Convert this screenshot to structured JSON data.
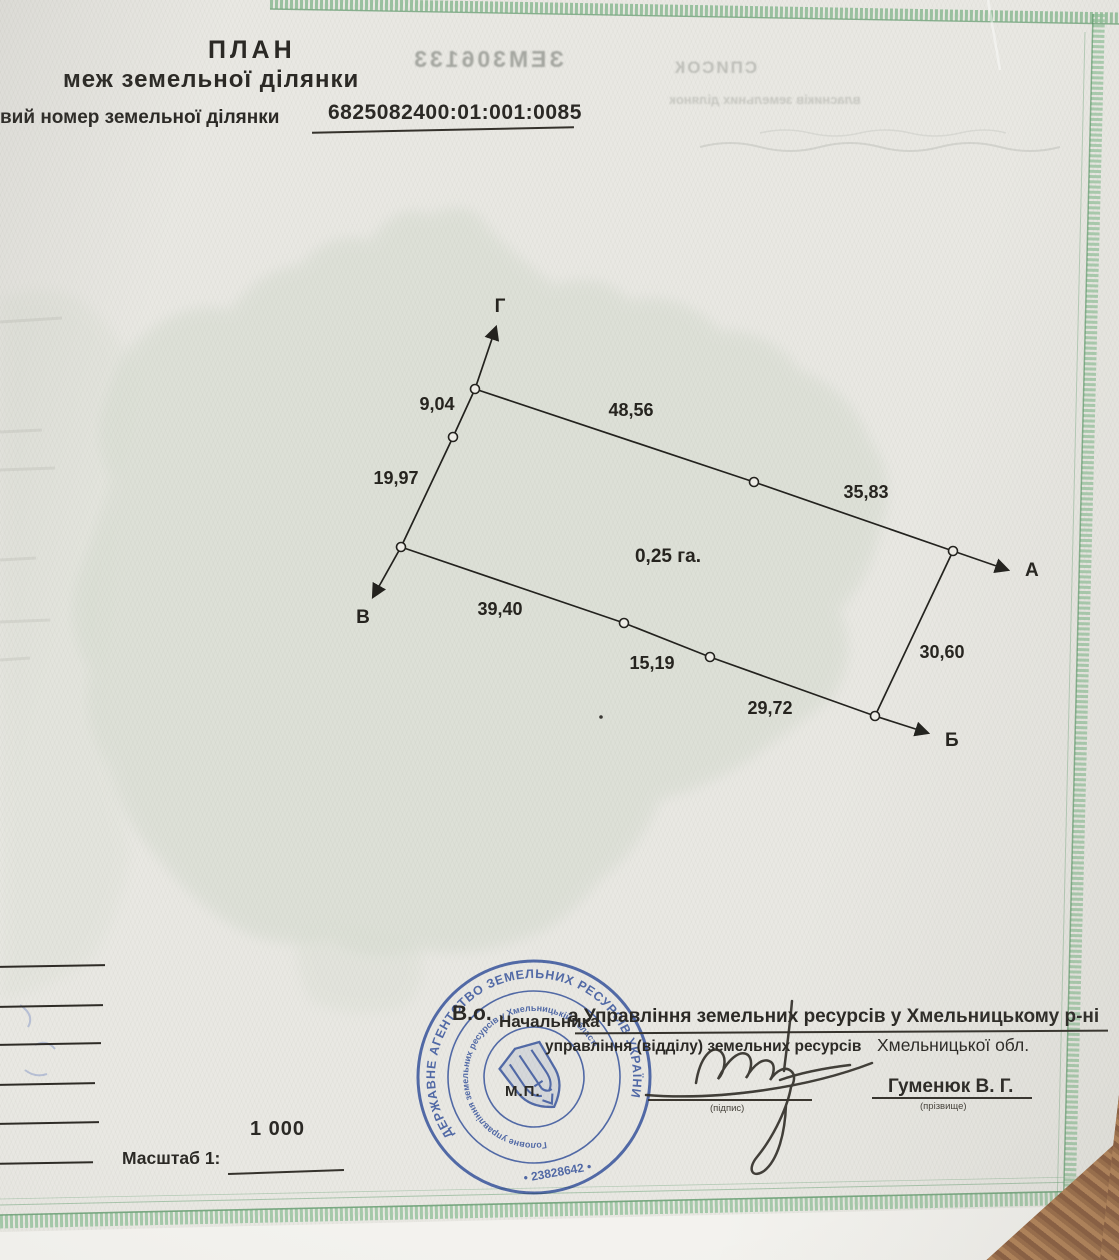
{
  "header": {
    "title": "ПЛАН",
    "subtitle": "меж земельної ділянки",
    "cadastral_label": "вий номер земельної ділянки",
    "cadastral_number": "6825082400:01:001:0085"
  },
  "plan": {
    "area": "0,25 га.",
    "points": {
      "top": "Г",
      "right": "А",
      "bottom": "Б",
      "left": "В"
    },
    "lengths": {
      "g_upper": "9,04",
      "g_lower": "19,97",
      "top_left": "48,56",
      "top_right": "35,83",
      "bottom_left": "39,40",
      "bottom_mid": "15,19",
      "bottom_right": "29,72",
      "right_side": "30,60"
    }
  },
  "scale": {
    "label": "Масштаб 1:",
    "value": "1 000"
  },
  "signing": {
    "acting": "В.о.",
    "position_printed": "Начальника",
    "typed_line": "а Управління земельних ресурсів у Хмельницькому р-ні",
    "form_line": "управління (відділу) земельних ресурсів",
    "region": "Хмельницької обл.",
    "seal_mark": "М.П.",
    "signature_caption": "(підпис)",
    "surname": "Гуменюк В. Г.",
    "surname_caption": "(прізвище)"
  },
  "stamp": {
    "ring_outer": "ДЕРЖАВНЕ АГЕНТСТВО ЗЕМЕЛЬНИХ РЕСУРСІВ УКРАЇНИ",
    "ring_number": "• 23828642 •",
    "ring_inner": "Головне управління земельних ресурсів у Хмельницькій області"
  },
  "bleedthrough": {
    "serial": "ЗЕМ306133",
    "line1": "СПИСОК",
    "line2": "власників земельних ділянок"
  }
}
